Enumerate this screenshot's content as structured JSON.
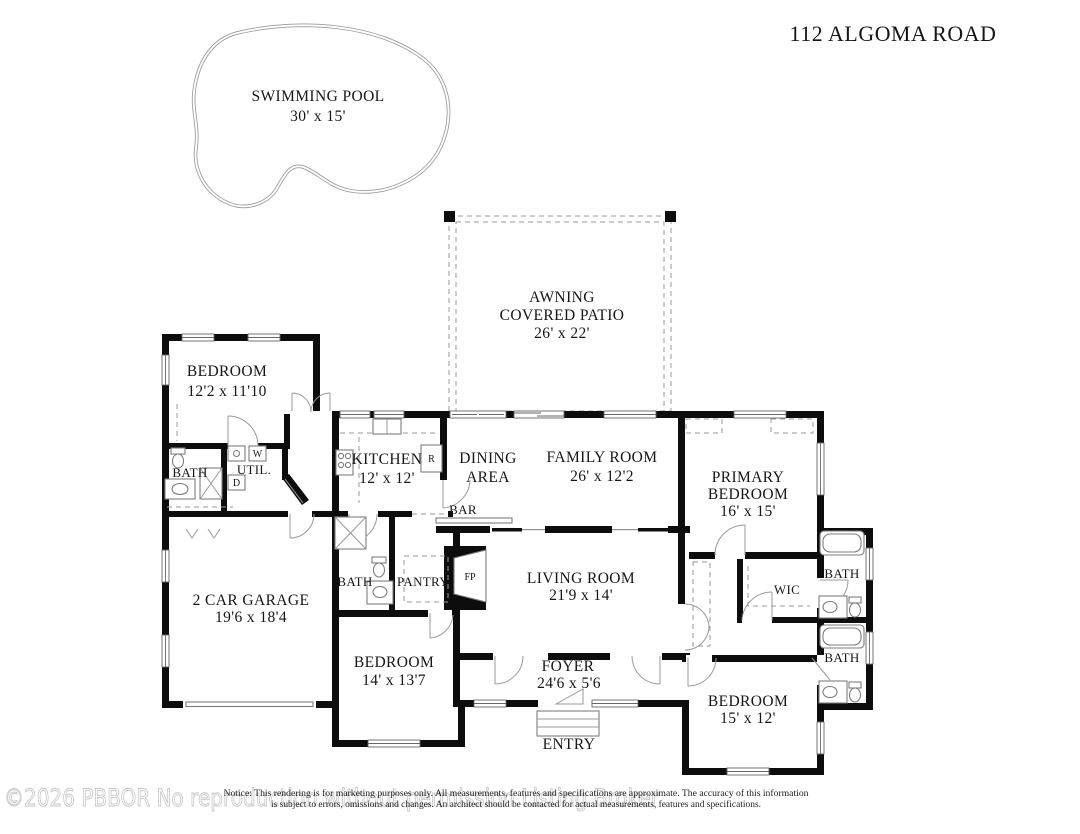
{
  "title": "112 ALGOMA ROAD",
  "pool": {
    "name": "SWIMMING POOL",
    "dims": "30' x 15'"
  },
  "patio": {
    "line1": "AWNING",
    "line2": "COVERED PATIO",
    "dims": "26' x 22'"
  },
  "rooms": {
    "bedroom_top_left": {
      "name": "BEDROOM",
      "dims": "12'2 x 11'10"
    },
    "bath_top_left": {
      "name": "BATH"
    },
    "utility": {
      "name": "UTIL."
    },
    "garage": {
      "name": "2 CAR GARAGE",
      "dims": "19'6 x 18'4"
    },
    "kitchen": {
      "name": "KITCHEN",
      "dims": "12' x 12'"
    },
    "dining": {
      "line1": "DINING",
      "line2": "AREA"
    },
    "family_room": {
      "name": "FAMILY ROOM",
      "dims": "26' x 12'2"
    },
    "primary_bedroom": {
      "line1": "PRIMARY",
      "line2": "BEDROOM",
      "dims": "16' x 15'"
    },
    "bar": {
      "name": "BAR"
    },
    "bath_hall": {
      "name": "BATH"
    },
    "pantry": {
      "name": "PANTRY"
    },
    "fireplace": {
      "name": "FP"
    },
    "living_room": {
      "name": "LIVING ROOM",
      "dims": "21'9 x 14'"
    },
    "wic": {
      "name": "WIC"
    },
    "bath_right_upper": {
      "name": "BATH"
    },
    "bath_right_lower": {
      "name": "BATH"
    },
    "bedroom_bottom_middle": {
      "name": "BEDROOM",
      "dims": "14' x 13'7"
    },
    "foyer": {
      "name": "FOYER",
      "dims": "24'6 x 5'6"
    },
    "bedroom_bottom_right": {
      "name": "BEDROOM",
      "dims": "15' x 12'"
    },
    "entry": {
      "name": "ENTRY"
    }
  },
  "appliances": {
    "washer": "W",
    "dryer": "D",
    "refrigerator": "R"
  },
  "watermark": "©2026 PBBOR No reproduction without permission Listing Broker",
  "disclaimer": {
    "line1": "Notice: This rendering is for marketing purposes only. All measurements, features and specifications are approximate. The accuracy of this information",
    "line2": "is subject to errors, omissions and changes. An architect should be contacted for actual measurements, features and specifications."
  },
  "colors": {
    "walls": "#000000",
    "thin_lines": "#8c8c8c",
    "watermark": "#c8c8c8",
    "background": "#ffffff"
  }
}
